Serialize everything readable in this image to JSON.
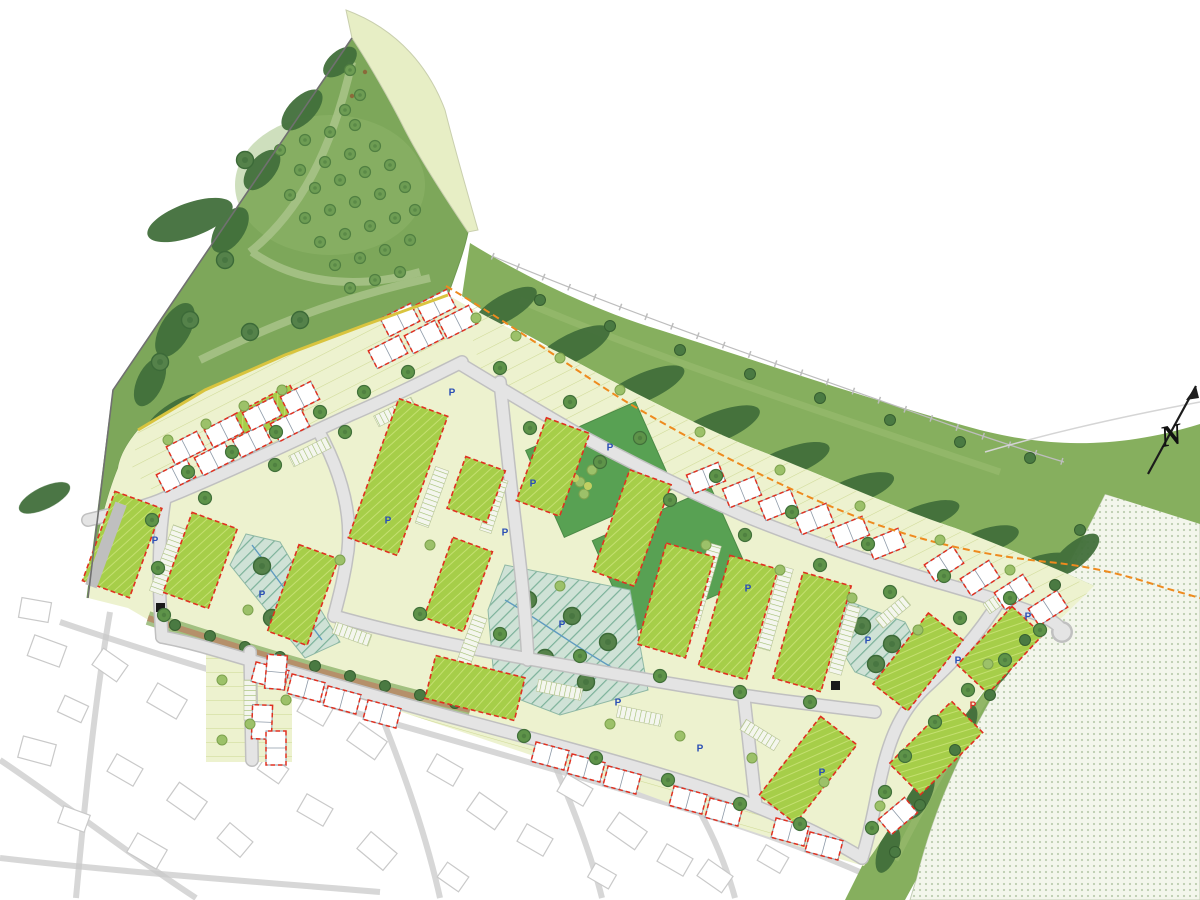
{
  "drawing": {
    "compass_label": "N",
    "parking_label": "P"
  },
  "colors": {
    "page_bg": "#ffffff",
    "park_green": "#7da75a",
    "park_light": "#93b96d",
    "band_green": "#86af5e",
    "pale_strip": "#e7eec5",
    "plot_pale": "#edf2cf",
    "plot_line": "#c8d488",
    "block_green": "#a6ce49",
    "block_hatch": "#c4e070",
    "open_green": "#58a153",
    "hedge_green": "#426f3b",
    "tree_green": "#5e9349",
    "tree_dark": "#41703a",
    "tree_light": "#9cc169",
    "tree_yellow": "#c2cf62",
    "road_gray": "#e4e4e4",
    "road_edge": "#c0c0c0",
    "building_white": "#ffffff",
    "building_stroke": "#8e9aa8",
    "red_dash": "#e03020",
    "orange_boundary": "#ee8a1e",
    "teal_base": "#cfe2d6",
    "teal_line": "#7cb29a",
    "swale_blue": "#5f9bc0",
    "path_brown": "#b5906a",
    "stipple_bg": "#f3f6ec",
    "stipple_dot": "#bccdb0",
    "context_line": "#c9c9c9",
    "boundary_dark": "#707070",
    "yellow_edge": "#d9c43e",
    "blue_marker": "#2b4fb5",
    "red_marker": "#d93025",
    "gray_court": "#bfbfbf",
    "black_feature": "#1a1a1a"
  },
  "markers": {
    "parking_blue": [
      [
        452,
        392
      ],
      [
        610,
        447
      ],
      [
        533,
        483
      ],
      [
        505,
        532
      ],
      [
        562,
        624
      ],
      [
        618,
        702
      ],
      [
        700,
        748
      ],
      [
        822,
        772
      ],
      [
        868,
        640
      ],
      [
        958,
        660
      ],
      [
        262,
        594
      ],
      [
        155,
        540
      ],
      [
        748,
        588
      ],
      [
        388,
        520
      ],
      [
        1028,
        616
      ]
    ],
    "parking_red": [
      [
        973,
        705
      ]
    ]
  },
  "zones_semantic": [
    {
      "id": "public-open-space-park",
      "color_key": "park_green"
    },
    {
      "id": "landscape-buffer-band",
      "color_key": "band_green"
    },
    {
      "id": "housing-terrace-block",
      "color_key": "block_green"
    },
    {
      "id": "private-plot",
      "color_key": "plot_pale"
    },
    {
      "id": "attenuation-swale",
      "color_key": "teal_base"
    },
    {
      "id": "proposed-house-unit",
      "color_key": "building_white"
    },
    {
      "id": "existing-context",
      "color_key": "context_line"
    },
    {
      "id": "agricultural-field",
      "color_key": "stipple_dot"
    },
    {
      "id": "site-boundary",
      "color_key": "orange_boundary"
    }
  ]
}
